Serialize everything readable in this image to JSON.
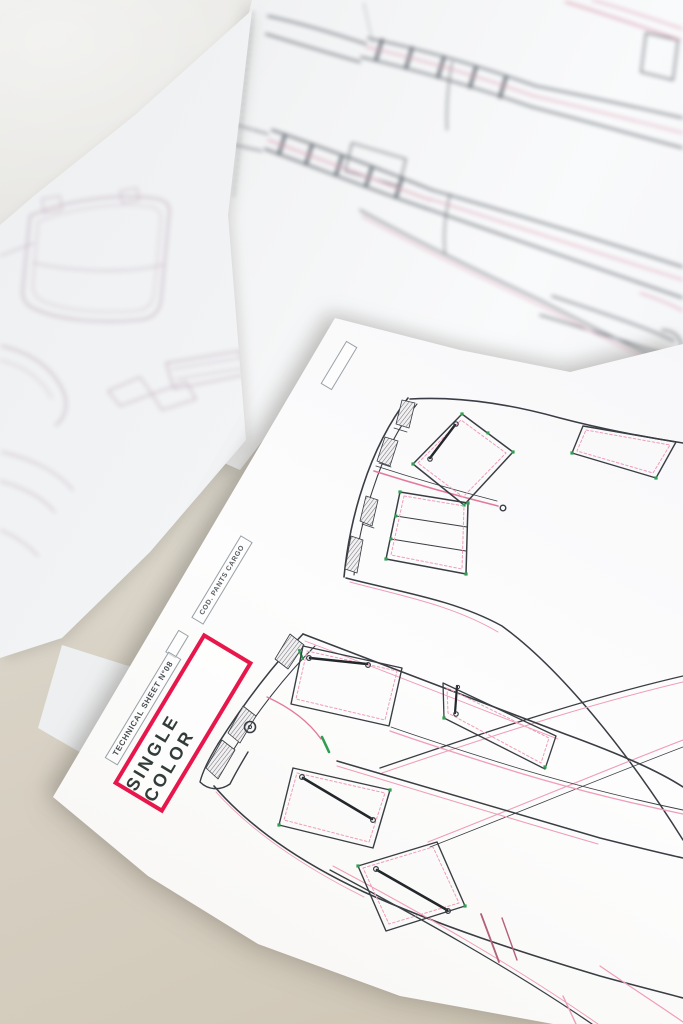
{
  "front_sheet": {
    "sheet_label": "TECHNICAL SHEET N°08",
    "code_label": "COD. PANTS CARGO",
    "color_mode_label": "SINGLE COLOR"
  },
  "colors": {
    "accent_red": "#e8174b",
    "line_dark": "#3a3e44",
    "stitch_pink": "#ef9db8",
    "stitch_strong_pink": "#e4799c",
    "bartack_green": "#2f9e52",
    "zipper_dark": "#23272c",
    "hem_maroon": "#b3607a",
    "paper_white": "#f8f8fa",
    "table_beige": "#d6cfc2",
    "table_gray": "#e5e5e2"
  }
}
